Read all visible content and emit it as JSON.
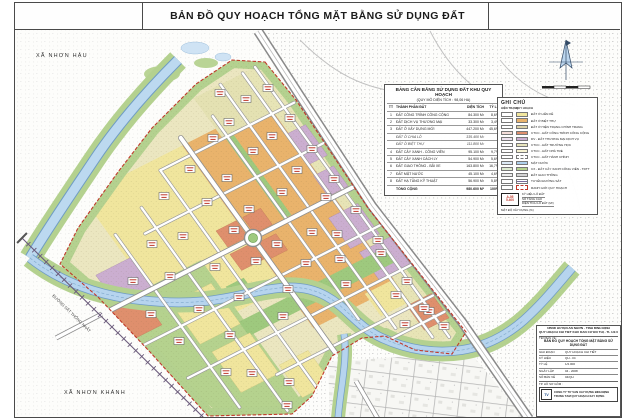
{
  "window": {
    "title": "BẢN ĐỒ QUY HOẠCH TỔNG MẶT BẰNG SỬ DỤNG ĐẤT"
  },
  "map": {
    "commune_top_left": "XÃ NHƠN HẬU",
    "commune_bottom_left": "XÃ NHƠN KHÁNH",
    "railway_label": "ĐƯỜNG SẮT THỐNG NHẤT"
  },
  "balance_table": {
    "title": "BẢNG CÂN BẰNG SỬ DỤNG ĐẤT KHU QUY HOẠCH",
    "subtitle": "(QUY MÔ DIỆN TÍCH : 98,06 HA)",
    "columns": {
      "tt": "TT",
      "name": "THÀNH PHẦN ĐẤT",
      "area": "DIỆN TÍCH",
      "pct": "TỶ LỆ"
    },
    "rows": [
      {
        "tt": "1",
        "name": "ĐẤT CÔNG TRÌNH CÔNG CỘNG",
        "area": "84.300 M²",
        "pct": "8,6%"
      },
      {
        "tt": "2",
        "name": "ĐẤT DỊCH VỤ THƯƠNG MẠI",
        "area": "33.300 M²",
        "pct": "3,4%"
      },
      {
        "tt": "3",
        "name": "ĐẤT Ở XÂY DỰNG MỚI",
        "area": "447.200 M²",
        "pct": "45,6%"
      },
      {
        "tt": "",
        "name": "ĐẤT Ở CHIA LÔ",
        "area": "335.400 M²",
        "pct": ""
      },
      {
        "tt": "",
        "name": "ĐẤT Ở BIỆT THỰ",
        "area": "111.800 M²",
        "pct": ""
      },
      {
        "tt": "4",
        "name": "ĐẤT CÂY XANH - CÔNG VIÊN",
        "area": "95.100 M²",
        "pct": "9,7%"
      },
      {
        "tt": "5",
        "name": "ĐẤT CÂY XANH CÁCH LY",
        "area": "54.900 M²",
        "pct": "5,6%"
      },
      {
        "tt": "6",
        "name": "ĐẤT GIAO THÔNG - BÃI XE",
        "area": "163.800 M²",
        "pct": "16,7%"
      },
      {
        "tt": "7",
        "name": "ĐẤT MẶT NƯỚC",
        "area": "45.100 M²",
        "pct": "4,6%"
      },
      {
        "tt": "8",
        "name": "ĐẤT HẠ TẦNG KỸ THUẬT",
        "area": "56.900 M²",
        "pct": "5,8%"
      },
      {
        "tt": "",
        "name": "TỔNG CỘNG",
        "area": "980.600 M²",
        "pct": "100%"
      }
    ]
  },
  "legend": {
    "title": "GHI CHÚ",
    "col_existing": "HIỆN TRẠNG",
    "col_planned": "QUY HOẠCH",
    "items": [
      {
        "label": "ĐẤT Ở LIỀN KỀ",
        "color": "#f2e79e"
      },
      {
        "label": "ĐẤT Ở BIỆT THỰ",
        "color": "#e9b36c"
      },
      {
        "label": "ĐẤT Ở HIỆN TRẠNG CHỈNH TRANG",
        "color": "#ddd3a8"
      },
      {
        "label": "CTCC - ĐẤT CÔNG TRÌNH CÔNG CỘNG",
        "color": "#df8f6d"
      },
      {
        "label": "DV - ĐẤT THƯƠNG MẠI DỊCH VỤ",
        "color": "#cbaed0"
      },
      {
        "label": "CTCC - ĐẤT TRƯỜNG HỌC",
        "color": "#e8e5bd"
      },
      {
        "label": "CTCC - ĐẤT NHÀ TRẺ",
        "color": "#f7f3d2"
      },
      {
        "label": "CTCC - ĐẤT HÀNH CHÍNH",
        "color": "#ffffff"
      },
      {
        "label": "MẶT NƯỚC",
        "color": "#aed0ec"
      },
      {
        "label": "CX - ĐẤT CÂY XANH CÔNG VIÊN - TDTT",
        "color": "#b5d28e"
      },
      {
        "label": "ĐẤT GIAO THÔNG",
        "color": "#d4d4d4"
      },
      {
        "label": "TUYẾN ĐƯỜNG SẮT",
        "color": "#7a6a9a"
      },
      {
        "label": "RANH GIỚI QUY HOẠCH",
        "color": "#c0392b"
      }
    ],
    "note": {
      "sample_code": "A-05",
      "sample_area": "5.400",
      "callout_code": "KÝ HIỆU LÔ ĐẤT",
      "callout_floors": "SỐ TẦNG CAO",
      "callout_area": "DIỆN TÍCH LÔ ĐẤT (M²)",
      "callout_density": "MẬT ĐỘ XÂY DỰNG (%)"
    }
  },
  "title_block": {
    "org_line1": "UBND HUYỆN AN NHƠN - TỈNH BÌNH ĐỊNH",
    "org_line2": "QUY HOẠCH CHI TIẾT KHU DÂN CƯ ĐÔ THỊ - TL 1/2.000",
    "sheet_label": "TÊN BẢN VẼ :",
    "sheet_name": "BẢN ĐỒ QUY HOẠCH TỔNG MẶT BẰNG SỬ DỤNG ĐẤT",
    "rows": [
      [
        "GIAI ĐOẠN",
        "QUY HOẠCH CHI TIẾT"
      ],
      [
        "KÝ HIỆU",
        "QH - 04"
      ],
      [
        "TỶ LỆ",
        "1/2.000"
      ],
      [
        "NGÀY LẬP",
        "04 - 2008"
      ],
      [
        "SỐ BẢN VẼ",
        "04/QH"
      ]
    ],
    "footer_note": "TP. HỒ SƠ GỒM :",
    "company_line1": "CÔNG TY TƯ VẤN XÂY DỰNG BÌNH ĐỊNH",
    "company_line2": "TRUNG TÂM QUY HOẠCH XÂY DỰNG"
  },
  "colors": {
    "residential_existing": "#f2e79e",
    "residential_new": "#e9b36c",
    "public_works": "#df8f6d",
    "commercial": "#cbaed0",
    "green_space": "#b5d28e",
    "water": "#aed0ec",
    "boundary_red": "#c0392b"
  }
}
